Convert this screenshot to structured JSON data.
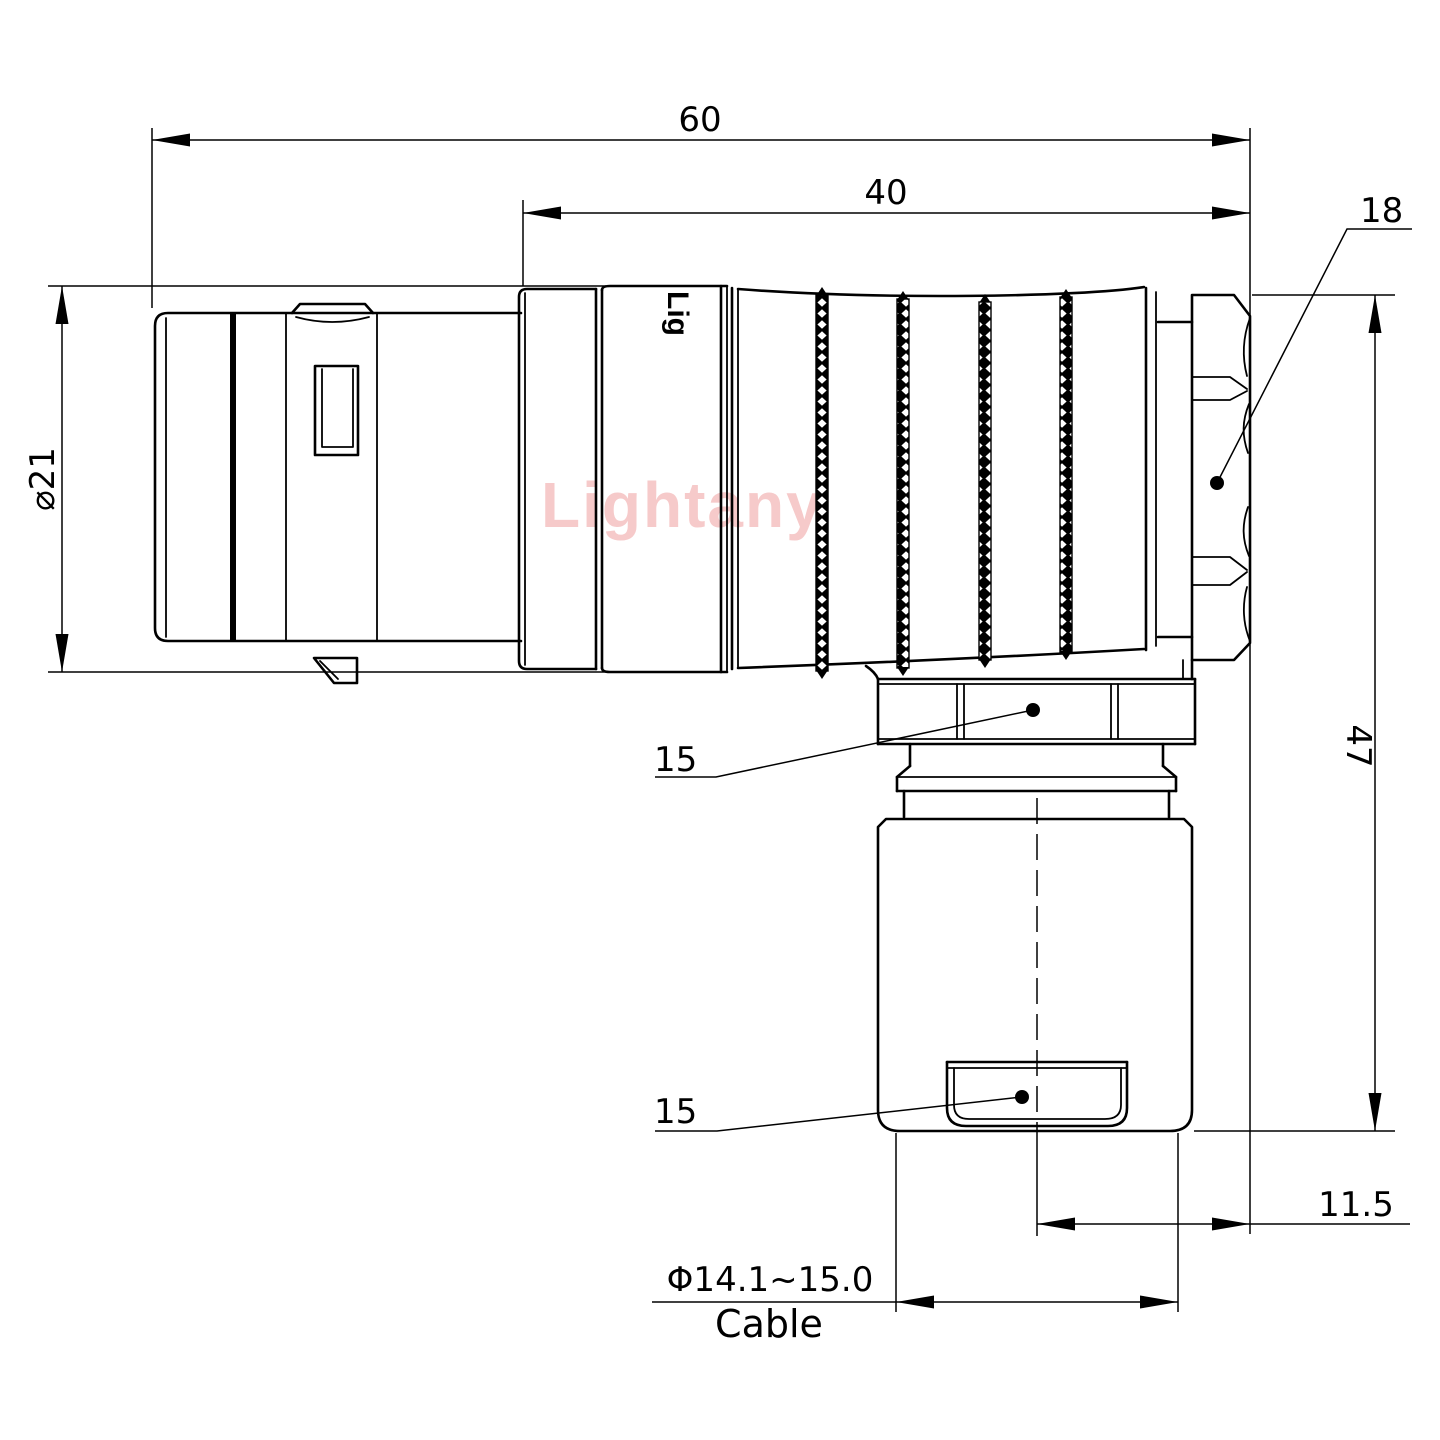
{
  "drawing": {
    "watermark": "Lightany",
    "body_marking": "Lig",
    "labels": {
      "overall_length": "60",
      "rear_length": "40",
      "backnut_size": "18",
      "front_diameter": "⌀21",
      "coupling_nut_size": "15",
      "gland_flat_size": "15",
      "overall_height": "47",
      "cable_offset": "11.5",
      "cable_diameter_range": "Φ14.1~15.0",
      "cable_label": "Cable"
    },
    "colors": {
      "line": "#000000",
      "watermark": "#f6caca",
      "background": "#ffffff"
    }
  }
}
